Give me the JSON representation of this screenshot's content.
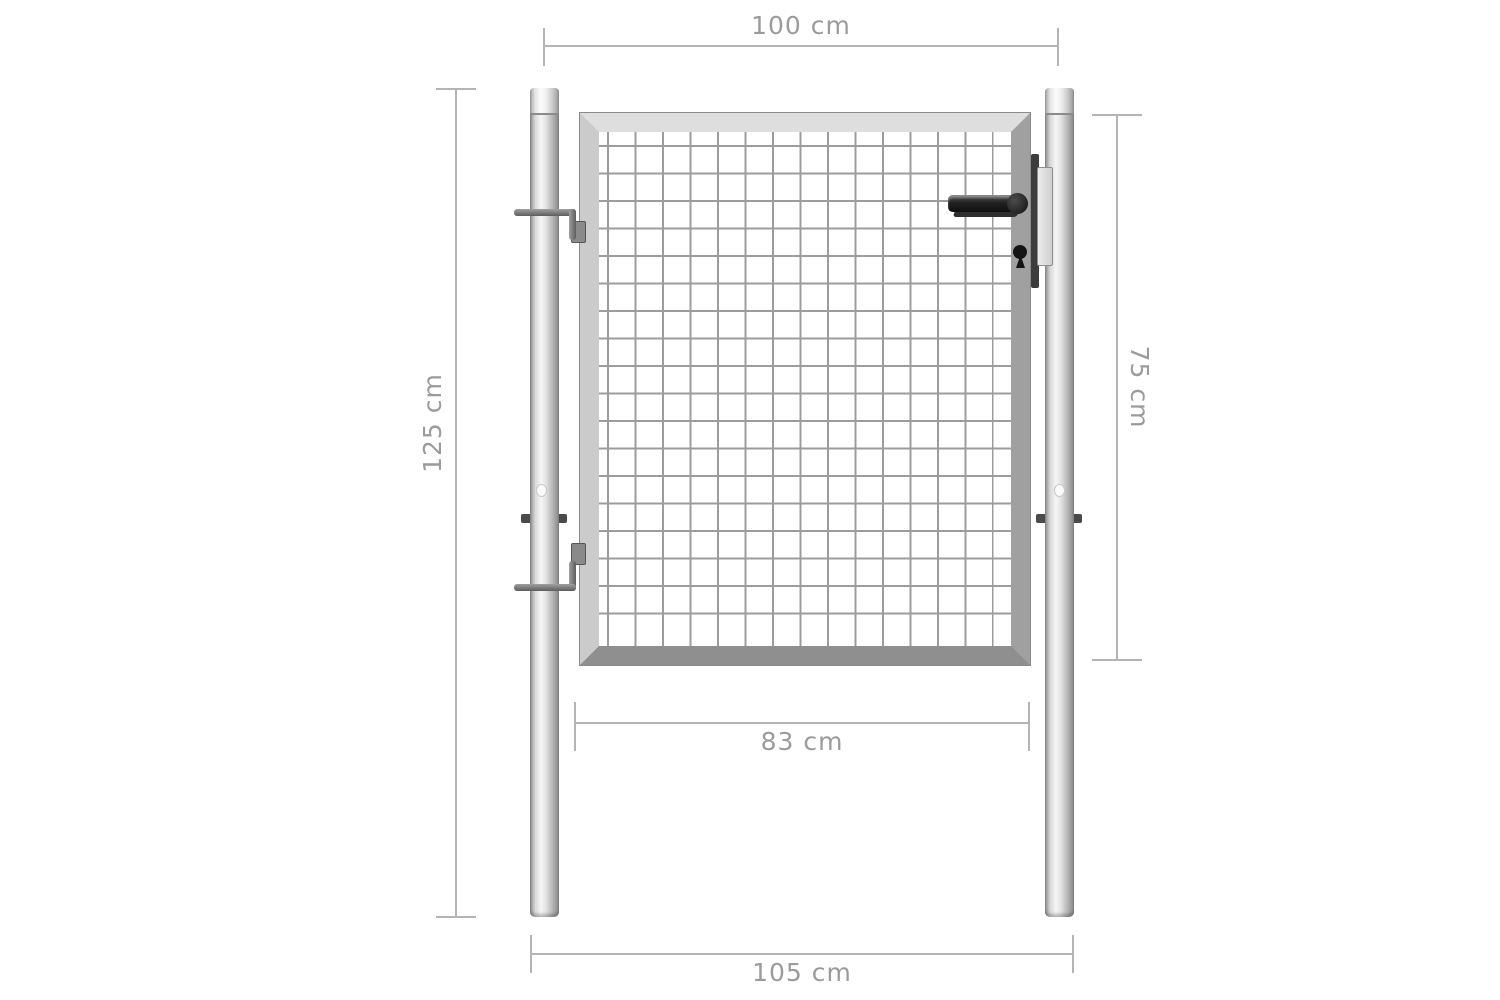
{
  "diagram": {
    "type": "product-dimension-diagram",
    "subject": "mesh garden gate with two round posts",
    "background": "#ffffff",
    "dimensions": {
      "top_width": {
        "label": "100 cm",
        "meaning": "post centre-to-centre width"
      },
      "left_height": {
        "label": "125 cm",
        "meaning": "total post height"
      },
      "right_height": {
        "label": "75 cm",
        "meaning": "gate panel height"
      },
      "inner_width": {
        "label": "83 cm",
        "meaning": "clear opening width"
      },
      "bottom_width": {
        "label": "105 cm",
        "meaning": "overall outer width"
      }
    },
    "colors": {
      "dimension_line": "#b4b4b4",
      "dimension_text": "#9b9b9b",
      "metal_light": "#f6f6f6",
      "metal_mid": "#c0c0c0",
      "metal_dark": "#8c8c8c",
      "mesh_line": "#9c9c9c",
      "hardware_dark": "#1e1e1e"
    },
    "parts": [
      "left-post",
      "right-post",
      "gate-frame",
      "wire-mesh-panel",
      "upper-hinge-pin",
      "lower-hinge-pin",
      "post-collar-lugs",
      "lever-handle",
      "lock-strip",
      "striker-plate",
      "keyhole"
    ]
  }
}
